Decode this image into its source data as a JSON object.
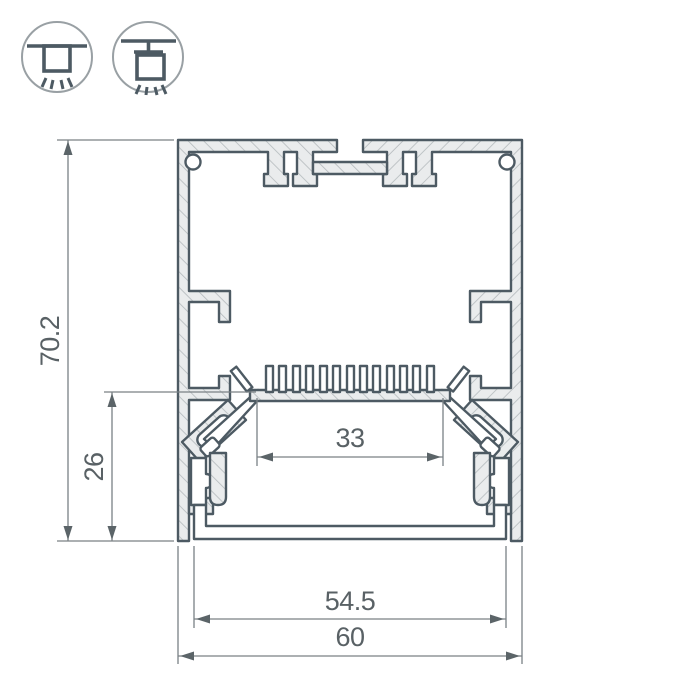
{
  "drawing": {
    "title": "led-profile-cross-section",
    "dimensions": {
      "height": "70.2",
      "mount_height": "26",
      "led_shelf_width": "33",
      "window_width": "54.5",
      "width": "60"
    },
    "icons": [
      {
        "name": "surface-mount-icon"
      },
      {
        "name": "pendant-mount-icon"
      }
    ],
    "colors": {
      "outline": "#4d5a63",
      "hatch_fill": "#eaeced",
      "hatch_line": "#b4babd",
      "dimension_line": "#7a8185",
      "dimension_text": "#596165",
      "icon_ring": "#99a0a4",
      "background": "#ffffff"
    }
  }
}
